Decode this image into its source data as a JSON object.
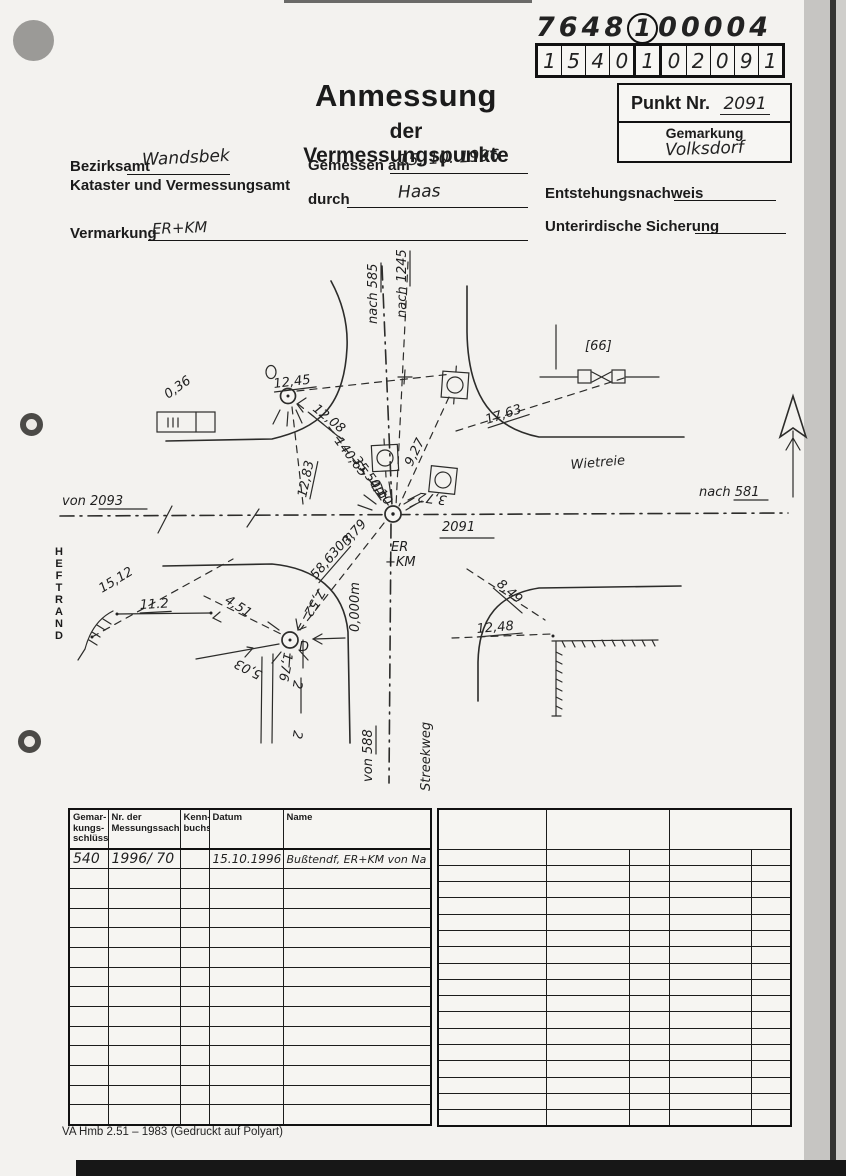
{
  "stamp": {
    "code": {
      "part1": "7648",
      "circled": "1",
      "part2": "00004"
    },
    "grid_digits": [
      "1",
      "5",
      "4",
      "0",
      "1",
      "0",
      "2",
      "0",
      "9",
      "1"
    ],
    "punkt_label": "Punkt Nr.",
    "punkt_value": "2091",
    "gemarkung_label": "Gemarkung",
    "gemarkung_value": "Volksdorf"
  },
  "title": {
    "main": "Anmessung",
    "sub": "der Vermessungspunkte"
  },
  "form": {
    "bezirksamt_label": "Bezirksamt",
    "bezirksamt_value": "Wandsbek",
    "kataster_line": "Kataster und Vermessungsamt",
    "gemessen_label": "Gemessen am",
    "gemessen_value": "15. 10. 1996",
    "durch_label": "durch",
    "durch_value": "Haas",
    "entstehung_label": "Entstehungsnachweis",
    "sicherung_label": "Unterirdische Sicherung",
    "vermarkung_label": "Vermarkung",
    "vermarkung_value": "ER+KM"
  },
  "sketch": {
    "heftrand": "H\nE\nF\nT\nR\nA\nN\nD",
    "routes": {
      "von_2093": "von 2093",
      "nach_581": "nach 581",
      "nach_585": "nach 585",
      "nach_1245": "nach 1245",
      "von_588": "von 588"
    },
    "streets": {
      "east": "Wietreie",
      "south": "Streekweg"
    },
    "points": {
      "main": "2091",
      "main_mark_1": "ER",
      "main_mark_2": "+KM",
      "d": "D",
      "bracket_66": "[66]",
      "parcel_a": "2",
      "parcel_b": "2"
    },
    "measurements": {
      "m0_36": "0,36",
      "m12_45": "12,45",
      "m12_08": "12,08",
      "m12_83": "12,83",
      "m140_65": "140,65",
      "m35_50": "35,50m",
      "m4_10": "4,10",
      "m9_27": "9,27",
      "m3_72": "3,72",
      "m17_63": "17,63",
      "m3_79": "3,79",
      "m58_630": "58,630m",
      "m0_000": "0,000m",
      "m15_12": "15,12",
      "m11_2": "11.2",
      "m4_51": "4,51",
      "m5_03": "5,03",
      "m7_52": "7,52",
      "m1_76": "1,76",
      "m8_49": "8,49",
      "m12_48": "12,48"
    }
  },
  "table_left": {
    "headers": [
      "Gemar-\nkungs-\nschlüssel",
      "Nr. der\nMessungssache",
      "Kenn-\nbuchst.",
      "Datum",
      "Name"
    ],
    "row": [
      "540",
      "1996/ 70",
      "",
      "15.10.1996",
      "Bußtendf, ER+KM von Na"
    ]
  },
  "footer": {
    "text": "VA Hmb 2.51 – 1983 (Gedruckt auf Polyart)"
  }
}
